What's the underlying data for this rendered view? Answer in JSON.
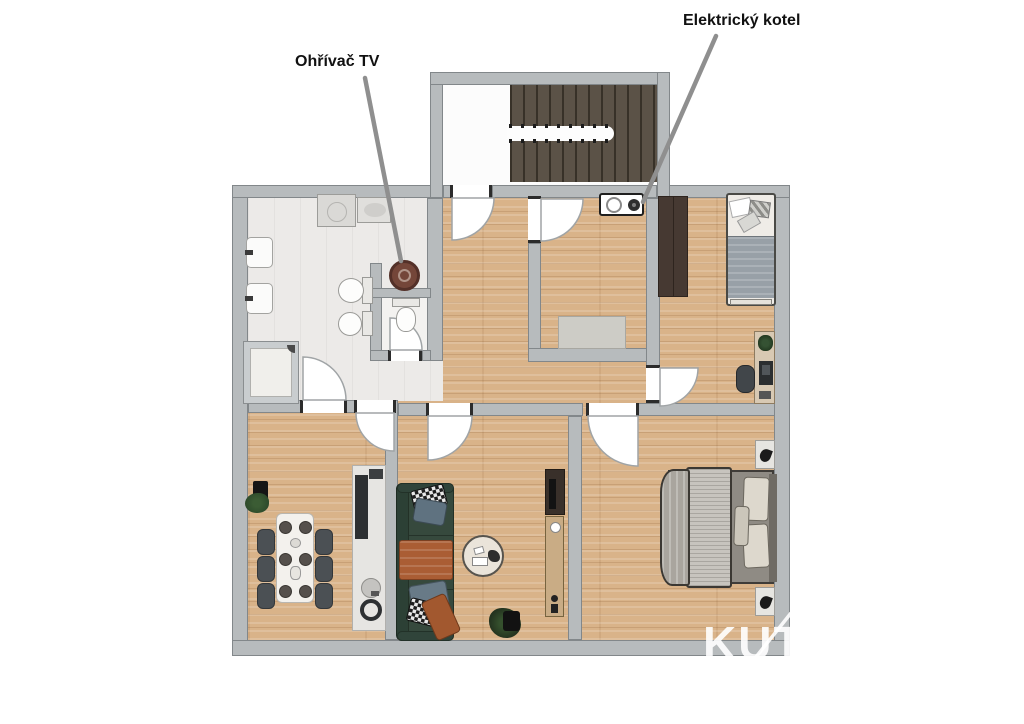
{
  "annotations": {
    "heater_label": "Ohřívač TV",
    "boiler_label": "Elektrický kotel"
  },
  "watermark": {
    "text": "KUT"
  },
  "colors": {
    "wall": "#b7bbbd",
    "wall_edge": "#82878a",
    "wood": "#d9b389",
    "bath_floor": "#eceae8",
    "stair": "#5b5247",
    "label_text": "#111111",
    "leader_line": "#8f8f8f",
    "sofa_green": "#36493d",
    "rust": "#aa5d34",
    "duvet_blue": "#98a0a7",
    "wardrobe_brown": "#463932",
    "heater_brown": "#744639",
    "chair_gray": "#4b5054"
  }
}
